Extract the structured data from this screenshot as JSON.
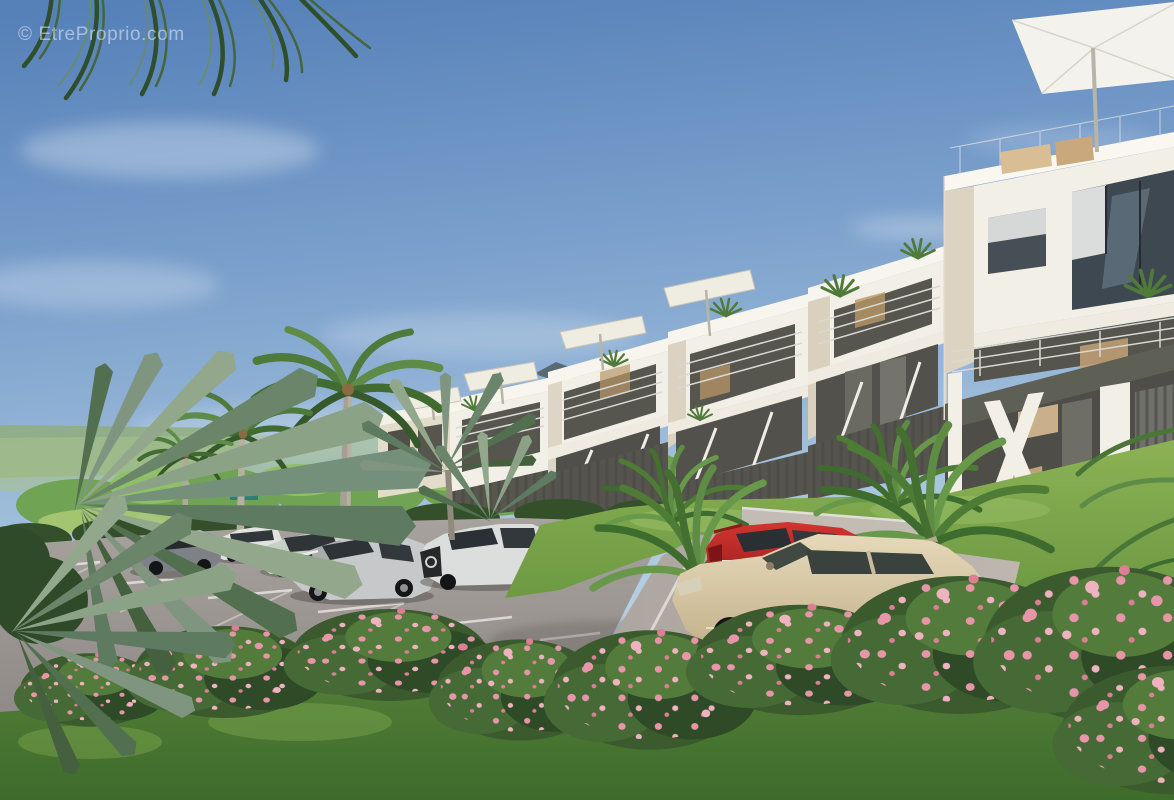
{
  "watermark": {
    "text": "© EtreProprio.com"
  },
  "scene": {
    "type": "architectural-3d-render",
    "setting": "tropical residential apartment complex with parking lot and landscaped slope",
    "sky": "clear blue sky with thin white clouds",
    "building": {
      "style": "modern stepped white terraced apartments",
      "features": [
        "balconies with glass and metal railings",
        "dark slatted ground-floor walls",
        "white diagonal support struts",
        "rooftop parasols",
        "potted balcony plants",
        "large glazed windows"
      ],
      "parasols_visible": 5
    },
    "vegetation": [
      "coconut palm trees",
      "gray-green fan palms",
      "oleander bushes with pink flowers",
      "lawn slope",
      "tropical shrubs",
      "background tree line"
    ],
    "parking": "gray asphalt lot with white stall markings and access ramp",
    "cars": [
      {
        "name": "dark sedan at left edge",
        "color_hex": "#2E3A4C"
      },
      {
        "name": "gray coupe",
        "color_hex": "#7E8287"
      },
      {
        "name": "white wagon",
        "color_hex": "#E2E3DF"
      },
      {
        "name": "pale green sedan",
        "color_hex": "#C3D2C4"
      },
      {
        "name": "navy sedan (back row)",
        "color_hex": "#3A4B66"
      },
      {
        "name": "white compact (back row)",
        "color_hex": "#E4E5E2"
      },
      {
        "name": "silver sedan",
        "color_hex": "#C6C8C9"
      },
      {
        "name": "white SUV",
        "color_hex": "#DCDEDD"
      },
      {
        "name": "red hatchback on ramp",
        "color_hex": "#C1272B"
      },
      {
        "name": "beige hatchback on ramp",
        "color_hex": "#D8C9A6"
      }
    ]
  },
  "palette": {
    "sky_top": "#5580B8",
    "sky_horizon": "#CBDEE9",
    "building_white": "#F2EFE6",
    "building_beige": "#D9D0BF",
    "recess_dark": "#56554E",
    "grass_light": "#8CB254",
    "grass_dark": "#3F6B2C",
    "asphalt": "#A49E9A",
    "flower_pink": "#E795A8",
    "palm_gray_green": "#7F957F"
  }
}
